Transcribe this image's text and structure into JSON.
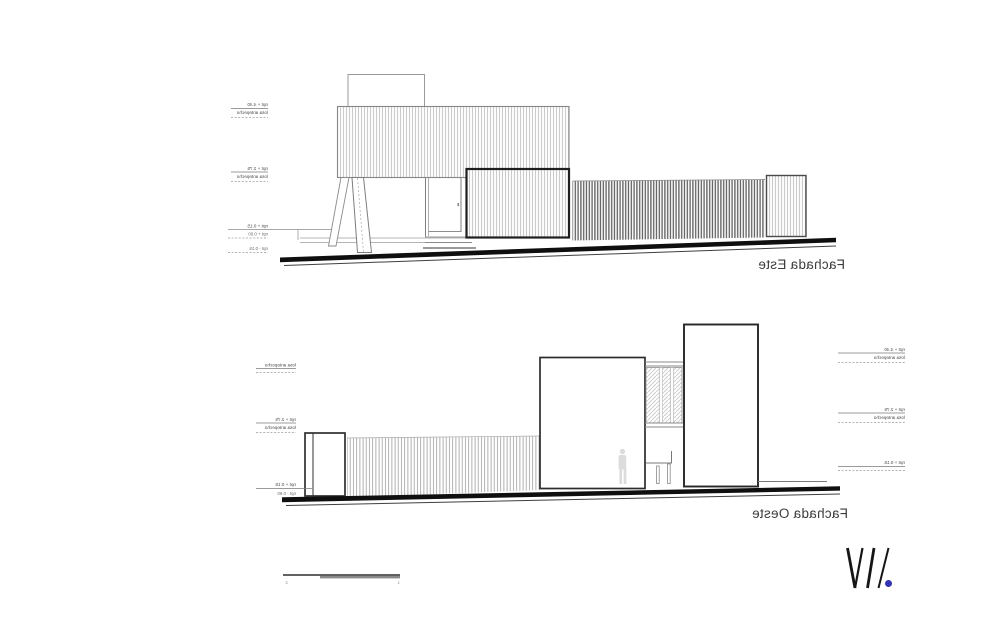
{
  "east_elevation": {
    "title": "Fachada Este",
    "levels": {
      "a1": "npt + 4.40",
      "a2": "losa antepecho",
      "b1": "npt + 2.75",
      "b2": "losa antepecho",
      "c1": "npt + 0.15",
      "c2": "npt + 0.00",
      "c3": "npt - 0.15"
    }
  },
  "west_elevation": {
    "title": "Fachada Oeste",
    "levels_left": {
      "a1": "losa antepecho",
      "b1": "npt + 2.75",
      "b2": "losa antepecho",
      "c1": "npt + 0.15",
      "c2": "npt - 0.90"
    },
    "levels_right": {
      "a1": "npt + 4.40",
      "a2": "losa antepecho",
      "b1": "npt + 2.75",
      "b2": "losa antepecho",
      "c1": "npt + 0.15"
    }
  },
  "scale_bar": {
    "left_label": "2",
    "right_label": "1"
  },
  "logo": {
    "dot_color": "#3434b2"
  }
}
